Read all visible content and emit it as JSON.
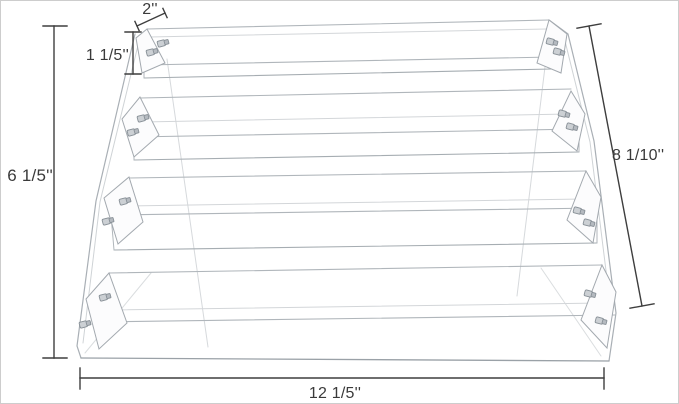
{
  "diagram": {
    "subject": "4-tier clear acrylic display riser dimension drawing",
    "tier_count": 4,
    "labels": {
      "shelf_depth": "2''",
      "tier_height": "1 1/5''",
      "overall_height": "6 1/5''",
      "slant_depth": "8 1/10''",
      "overall_width": "12 1/5''"
    },
    "colors": {
      "background": "#ffffff",
      "frame_border": "#cdcdcd",
      "acrylic_edge": "#a9afb5",
      "acrylic_edge_faint": "#d6d9dc",
      "dimension_line": "#3e3e3e",
      "label_text": "#3a3a3a",
      "screw_fill": "#ccd0d4",
      "screw_stroke": "#878f96"
    }
  }
}
